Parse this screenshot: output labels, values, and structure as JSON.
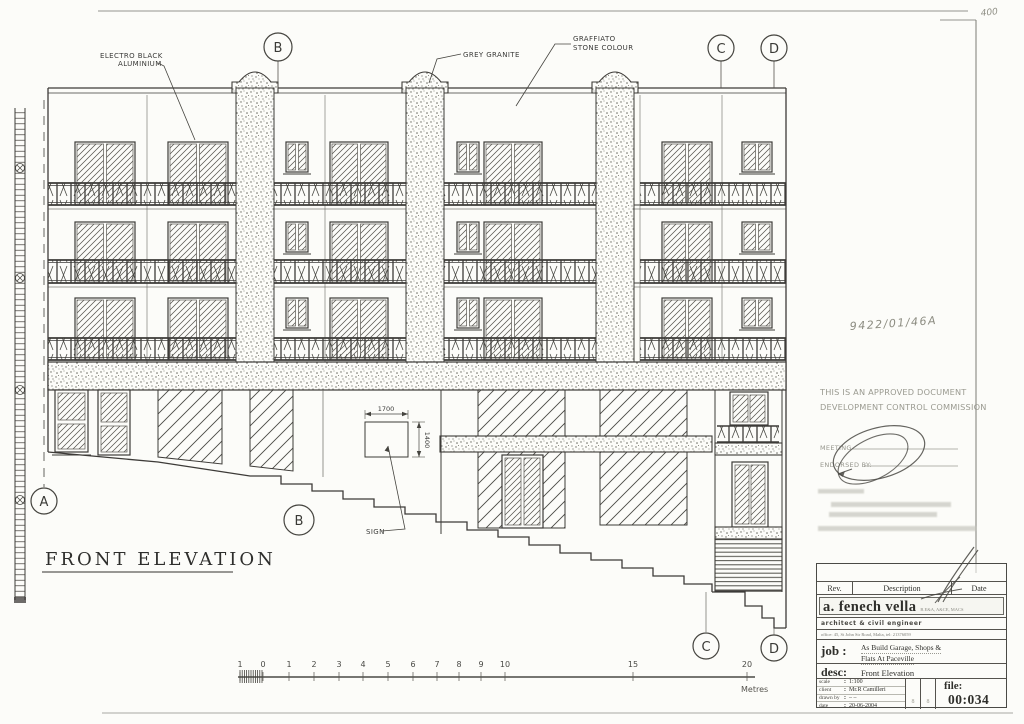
{
  "sheet": {
    "corner_note": "400",
    "reference_number": "9422/01/46A",
    "stamp": {
      "line1": "THIS IS AN APPROVED DOCUMENT",
      "line2": "DEVELOPMENT CONTROL COMMISSION"
    },
    "meeting_label": "MEETING",
    "endorsed_label": "ENDORSED BY:"
  },
  "drawing": {
    "title": "FRONT ELEVATION",
    "material_labels": {
      "electro_black_line1": "ELECTRO BLACK",
      "electro_black_line2": "ALUMINIUM",
      "grey_granite": "GREY GRANITE",
      "graffiato_line1": "GRAFFIATO",
      "graffiato_line2": "STONE COLOUR"
    },
    "sign_label": "SIGN",
    "sign_dimensions": {
      "width": "1700",
      "height": "1400"
    },
    "grid_markers": {
      "top": [
        {
          "label": "B"
        },
        {
          "label": "C"
        },
        {
          "label": "D"
        }
      ],
      "bottom": [
        {
          "label": "A"
        },
        {
          "label": "B"
        },
        {
          "label": "C"
        },
        {
          "label": "D"
        }
      ]
    },
    "scale_bar": {
      "ticks": [
        "1",
        "0",
        "1",
        "2",
        "3",
        "4",
        "5",
        "6",
        "7",
        "8",
        "9",
        "10",
        "15",
        "20"
      ],
      "unit": "Metres"
    }
  },
  "title_block": {
    "headers": {
      "rev": "Rev.",
      "description": "Description",
      "date": "Date"
    },
    "firm": {
      "name": "a. fenech vella",
      "credentials": "B.E&A, A&CE, MACS",
      "role": "architect & civil engineer",
      "address": "office: 45, St John Str Road, Malta, tel: 21376059"
    },
    "job": {
      "label": "job :",
      "line1": "As Build Garage, Shops &",
      "line2": "Flats At Paceville"
    },
    "desc": {
      "label": "desc:",
      "value": "Front Elevation"
    },
    "meta": {
      "scale_label": "scale",
      "scale_value": "1:100",
      "client_label": "client",
      "client_value": "Mr.R Camilleri",
      "drawn_label": "drawn by",
      "drawn_value": "– –",
      "date_label": "date",
      "date_value": "20-06-2004"
    },
    "approval_cols": {
      "col1": "8",
      "col2": "8"
    },
    "file": {
      "label": "file:",
      "value": "00:034"
    }
  },
  "colors": {
    "ink": "#3d3b38",
    "faded_ink": "#9a9a90",
    "paper": "#fcfcf9"
  }
}
